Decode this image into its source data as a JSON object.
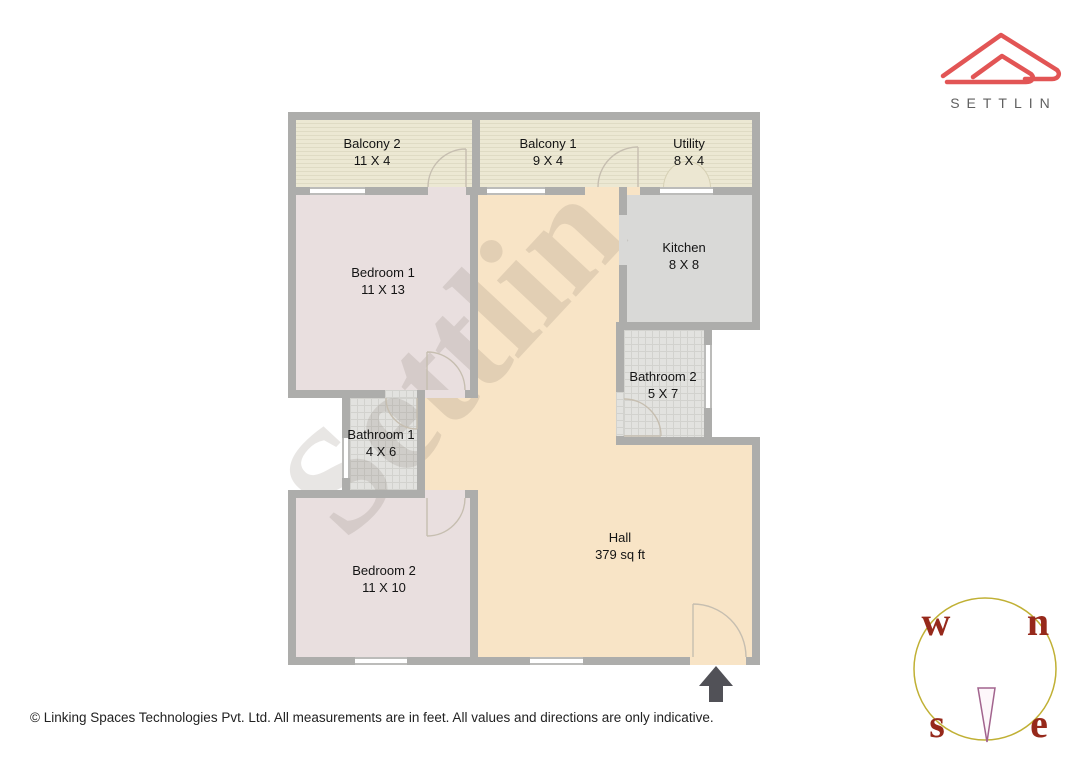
{
  "brand": {
    "name": "SETTLIN"
  },
  "watermark": {
    "text": "Settlin"
  },
  "floorplan": {
    "rooms": [
      {
        "id": "balcony2",
        "name": "Balcony 2",
        "dims": "11 X 4"
      },
      {
        "id": "balcony1",
        "name": "Balcony 1",
        "dims": "9 X 4"
      },
      {
        "id": "utility",
        "name": "Utility",
        "dims": "8 X 4"
      },
      {
        "id": "bedroom1",
        "name": "Bedroom 1",
        "dims": "11 X 13"
      },
      {
        "id": "kitchen",
        "name": "Kitchen",
        "dims": "8 X 8"
      },
      {
        "id": "bathroom2",
        "name": "Bathroom 2",
        "dims": "5 X 7"
      },
      {
        "id": "bathroom1",
        "name": "Bathroom 1",
        "dims": "4 X 6"
      },
      {
        "id": "bedroom2",
        "name": "Bedroom 2",
        "dims": "11 X 10"
      },
      {
        "id": "hall",
        "name": "Hall",
        "dims": "379 sq ft"
      }
    ]
  },
  "compass": {
    "west": "w",
    "north": "n",
    "south": "s",
    "east": "e"
  },
  "footer": {
    "copyright": "© Linking Spaces Technologies Pvt. Ltd. All measurements are in feet. All values and directions are only indicative."
  },
  "colors": {
    "wall": "#adadab",
    "hall": "#f8e4c6",
    "bedroom": "#e9dfdf",
    "balcony": "#ece8d3",
    "kitchen": "#d9d9d7",
    "bathroom": "#e2e2df",
    "logo_red": "#e25555",
    "compass_ring": "#c0b034",
    "compass_letters": "#96291b",
    "entry_arrow": "#515157"
  }
}
